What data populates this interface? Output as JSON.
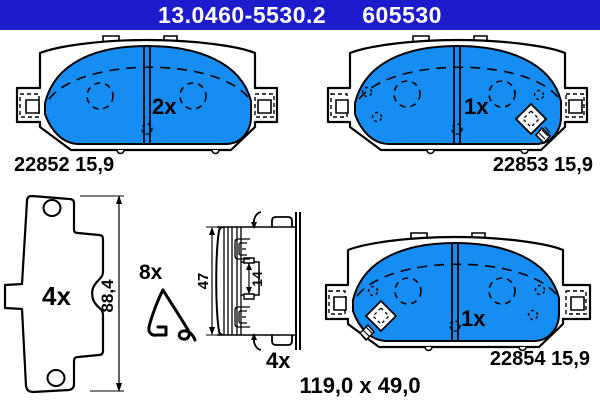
{
  "header": {
    "part_number": "13.0460-5530.2",
    "ref_number": "605530"
  },
  "colors": {
    "header_blue": "#1c1ccd",
    "pad_blue": "#168df2",
    "line": "#000000"
  },
  "pads": {
    "top_left": {
      "qty": "2x",
      "label": "22852 15,9"
    },
    "top_right": {
      "qty": "1x",
      "label": "22853 15,9"
    },
    "bottom_right": {
      "qty": "1x",
      "label": "22854 15,9"
    }
  },
  "hardware": {
    "backplate": {
      "qty": "4x",
      "dim_height": "88,4"
    },
    "spring_clip": {
      "qty": "8x"
    },
    "section_view": {
      "qty": "4x",
      "dim_width": "47",
      "dim_tab_gap": "14"
    }
  },
  "overall_dimensions": "119,0 x 49,0"
}
